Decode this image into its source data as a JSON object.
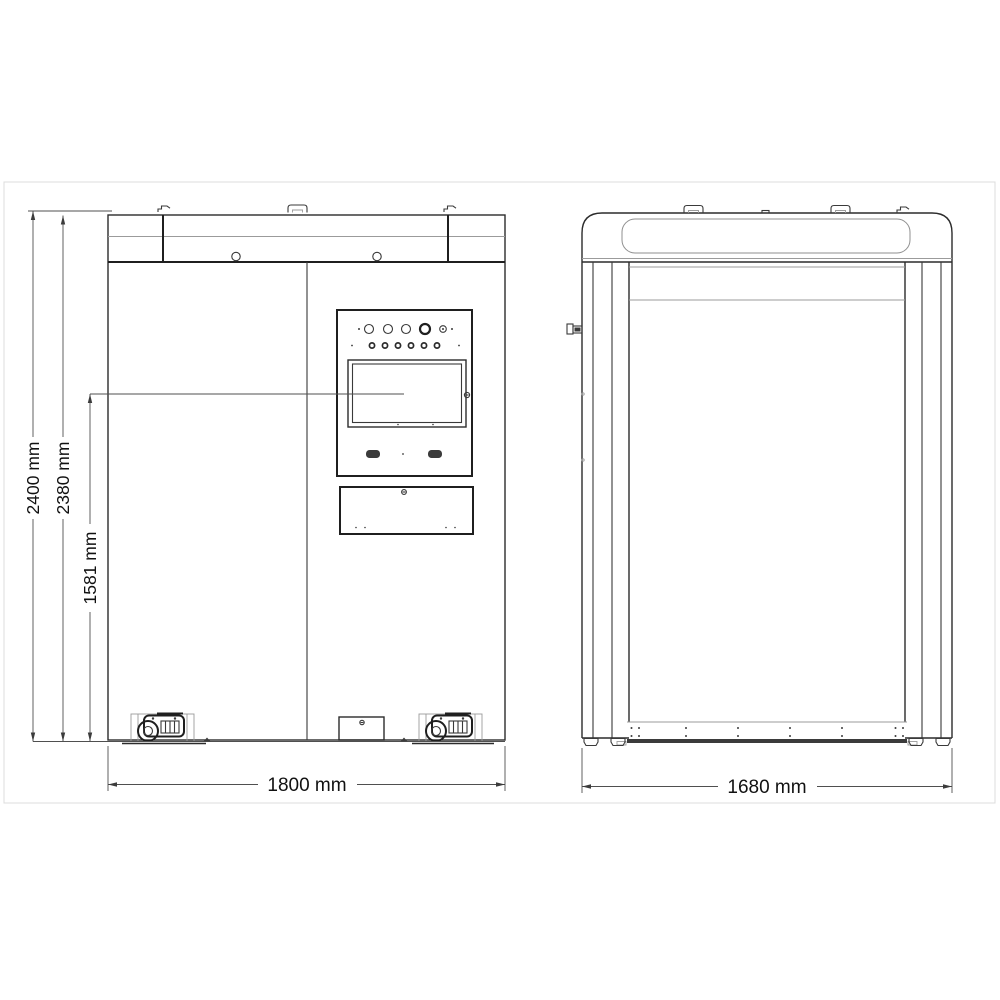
{
  "drawing": {
    "kind": "two-view dimensional engineering drawing of an equipment cabinet",
    "views": {
      "front": "front elevation with control panel and casters",
      "side": "rear elevation with door opening and threshold sill"
    },
    "dimensions": {
      "overall_height": "2400 mm",
      "body_height": "2380 mm",
      "screen_center_height": "1581 mm",
      "front_width": "1800 mm",
      "side_width": "1680 mm"
    },
    "colors": {
      "line": "#3a3a3a",
      "bold_line": "#1f1f1f",
      "light_line": "#9b9b9b",
      "dimension_line": "#4f4f4f",
      "text": "#111111",
      "dark_fill": "#3b3b3b",
      "background": "#ffffff",
      "page_border": "#dcdcdc"
    }
  }
}
